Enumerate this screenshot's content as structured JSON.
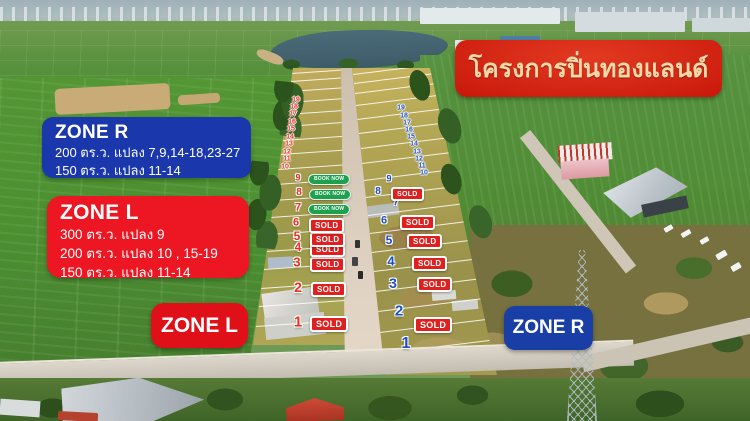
{
  "banner": {
    "text": "โครงการปิ่นทองแลนด์"
  },
  "info_boxes": {
    "zone_r": {
      "title": "ZONE R",
      "lines": [
        "200 ตร.ว. แปลง 7,9,14-18,23-27",
        "150 ตร.ว.  แปลง 11-14"
      ]
    },
    "zone_l": {
      "title": "ZONE L",
      "lines": [
        "300 ตร.ว. แปลง 9",
        "200 ตร.ว. แปลง 10 , 15-19",
        "150 ตร.ว.  แปลง 11-14"
      ]
    }
  },
  "zone_tags": {
    "left": "ZONE L",
    "right": "ZONE R"
  },
  "badge_labels": {
    "sold": "SOLD",
    "book_now": "BOOK NOW"
  },
  "colors": {
    "banner_bg": "#c9170a",
    "banner_text": "#f3d9a7",
    "info_blue": "#1a38ac",
    "info_red": "#ec1723",
    "tag_red": "#e01019",
    "tag_blue": "#193ea6",
    "sold_bg": "#e0201f",
    "book_now_bg": "#1ea14f",
    "number_red": "#ef2c1d",
    "number_blue": "#1d4ec2"
  },
  "plots": {
    "left": [
      {
        "n": "1",
        "x": 298,
        "y": 322,
        "badge": "sold",
        "bx": 310,
        "by": 316
      },
      {
        "n": "2",
        "x": 298,
        "y": 287,
        "badge": "sold",
        "bx": 311,
        "by": 282
      },
      {
        "n": "3",
        "x": 297,
        "y": 262,
        "badge": "sold",
        "bx": 310,
        "by": 257
      },
      {
        "n": "4",
        "x": 298,
        "y": 247,
        "badge": "sold",
        "bx": 310,
        "by": 242
      },
      {
        "n": "5",
        "x": 297,
        "y": 236,
        "badge": "sold",
        "bx": 310,
        "by": 232
      },
      {
        "n": "6",
        "x": 296,
        "y": 223,
        "badge": "sold",
        "bx": 309,
        "by": 218
      },
      {
        "n": "7",
        "x": 298,
        "y": 208,
        "badge": "book_now",
        "bx": 308,
        "by": 204
      },
      {
        "n": "8",
        "x": 299,
        "y": 193,
        "badge": "book_now",
        "bx": 309,
        "by": 189
      },
      {
        "n": "9",
        "x": 298,
        "y": 178,
        "badge": "book_now",
        "bx": 308,
        "by": 174
      }
    ],
    "right": [
      {
        "n": "1",
        "x": 406,
        "y": 344,
        "badge": null
      },
      {
        "n": "2",
        "x": 399,
        "y": 311,
        "badge": "sold",
        "bx": 414,
        "by": 317
      },
      {
        "n": "3",
        "x": 393,
        "y": 283,
        "badge": "sold",
        "bx": 417,
        "by": 277
      },
      {
        "n": "4",
        "x": 391,
        "y": 261,
        "badge": "sold",
        "bx": 412,
        "by": 256
      },
      {
        "n": "5",
        "x": 389,
        "y": 240,
        "badge": "sold",
        "bx": 407,
        "by": 234
      },
      {
        "n": "6",
        "x": 384,
        "y": 221,
        "badge": "sold",
        "bx": 400,
        "by": 215
      },
      {
        "n": "7",
        "x": 396,
        "y": 203,
        "badge": null
      },
      {
        "n": "8",
        "x": 378,
        "y": 192,
        "badge": "sold",
        "bx": 391,
        "by": 187
      },
      {
        "n": "9",
        "x": 389,
        "y": 179,
        "badge": null
      }
    ]
  },
  "strip_numbers": {
    "left": {
      "items": [
        {
          "n": "10",
          "x": 285,
          "y": 167
        },
        {
          "n": "11",
          "x": 287,
          "y": 159
        },
        {
          "n": "12",
          "x": 287,
          "y": 152
        },
        {
          "n": "13",
          "x": 289,
          "y": 144
        },
        {
          "n": "14",
          "x": 290,
          "y": 137
        },
        {
          "n": "15",
          "x": 291,
          "y": 129
        },
        {
          "n": "16",
          "x": 292,
          "y": 122
        },
        {
          "n": "17",
          "x": 293,
          "y": 114
        },
        {
          "n": "18",
          "x": 294,
          "y": 107
        },
        {
          "n": "19",
          "x": 296,
          "y": 100
        }
      ]
    },
    "right": {
      "items": [
        {
          "n": "10",
          "x": 424,
          "y": 173
        },
        {
          "n": "11",
          "x": 422,
          "y": 166
        },
        {
          "n": "12",
          "x": 419,
          "y": 159
        },
        {
          "n": "13",
          "x": 417,
          "y": 152
        },
        {
          "n": "14",
          "x": 414,
          "y": 144
        },
        {
          "n": "15",
          "x": 411,
          "y": 137
        },
        {
          "n": "16",
          "x": 409,
          "y": 130
        },
        {
          "n": "17",
          "x": 407,
          "y": 123
        },
        {
          "n": "18",
          "x": 404,
          "y": 116
        },
        {
          "n": "19",
          "x": 401,
          "y": 108
        }
      ]
    }
  }
}
